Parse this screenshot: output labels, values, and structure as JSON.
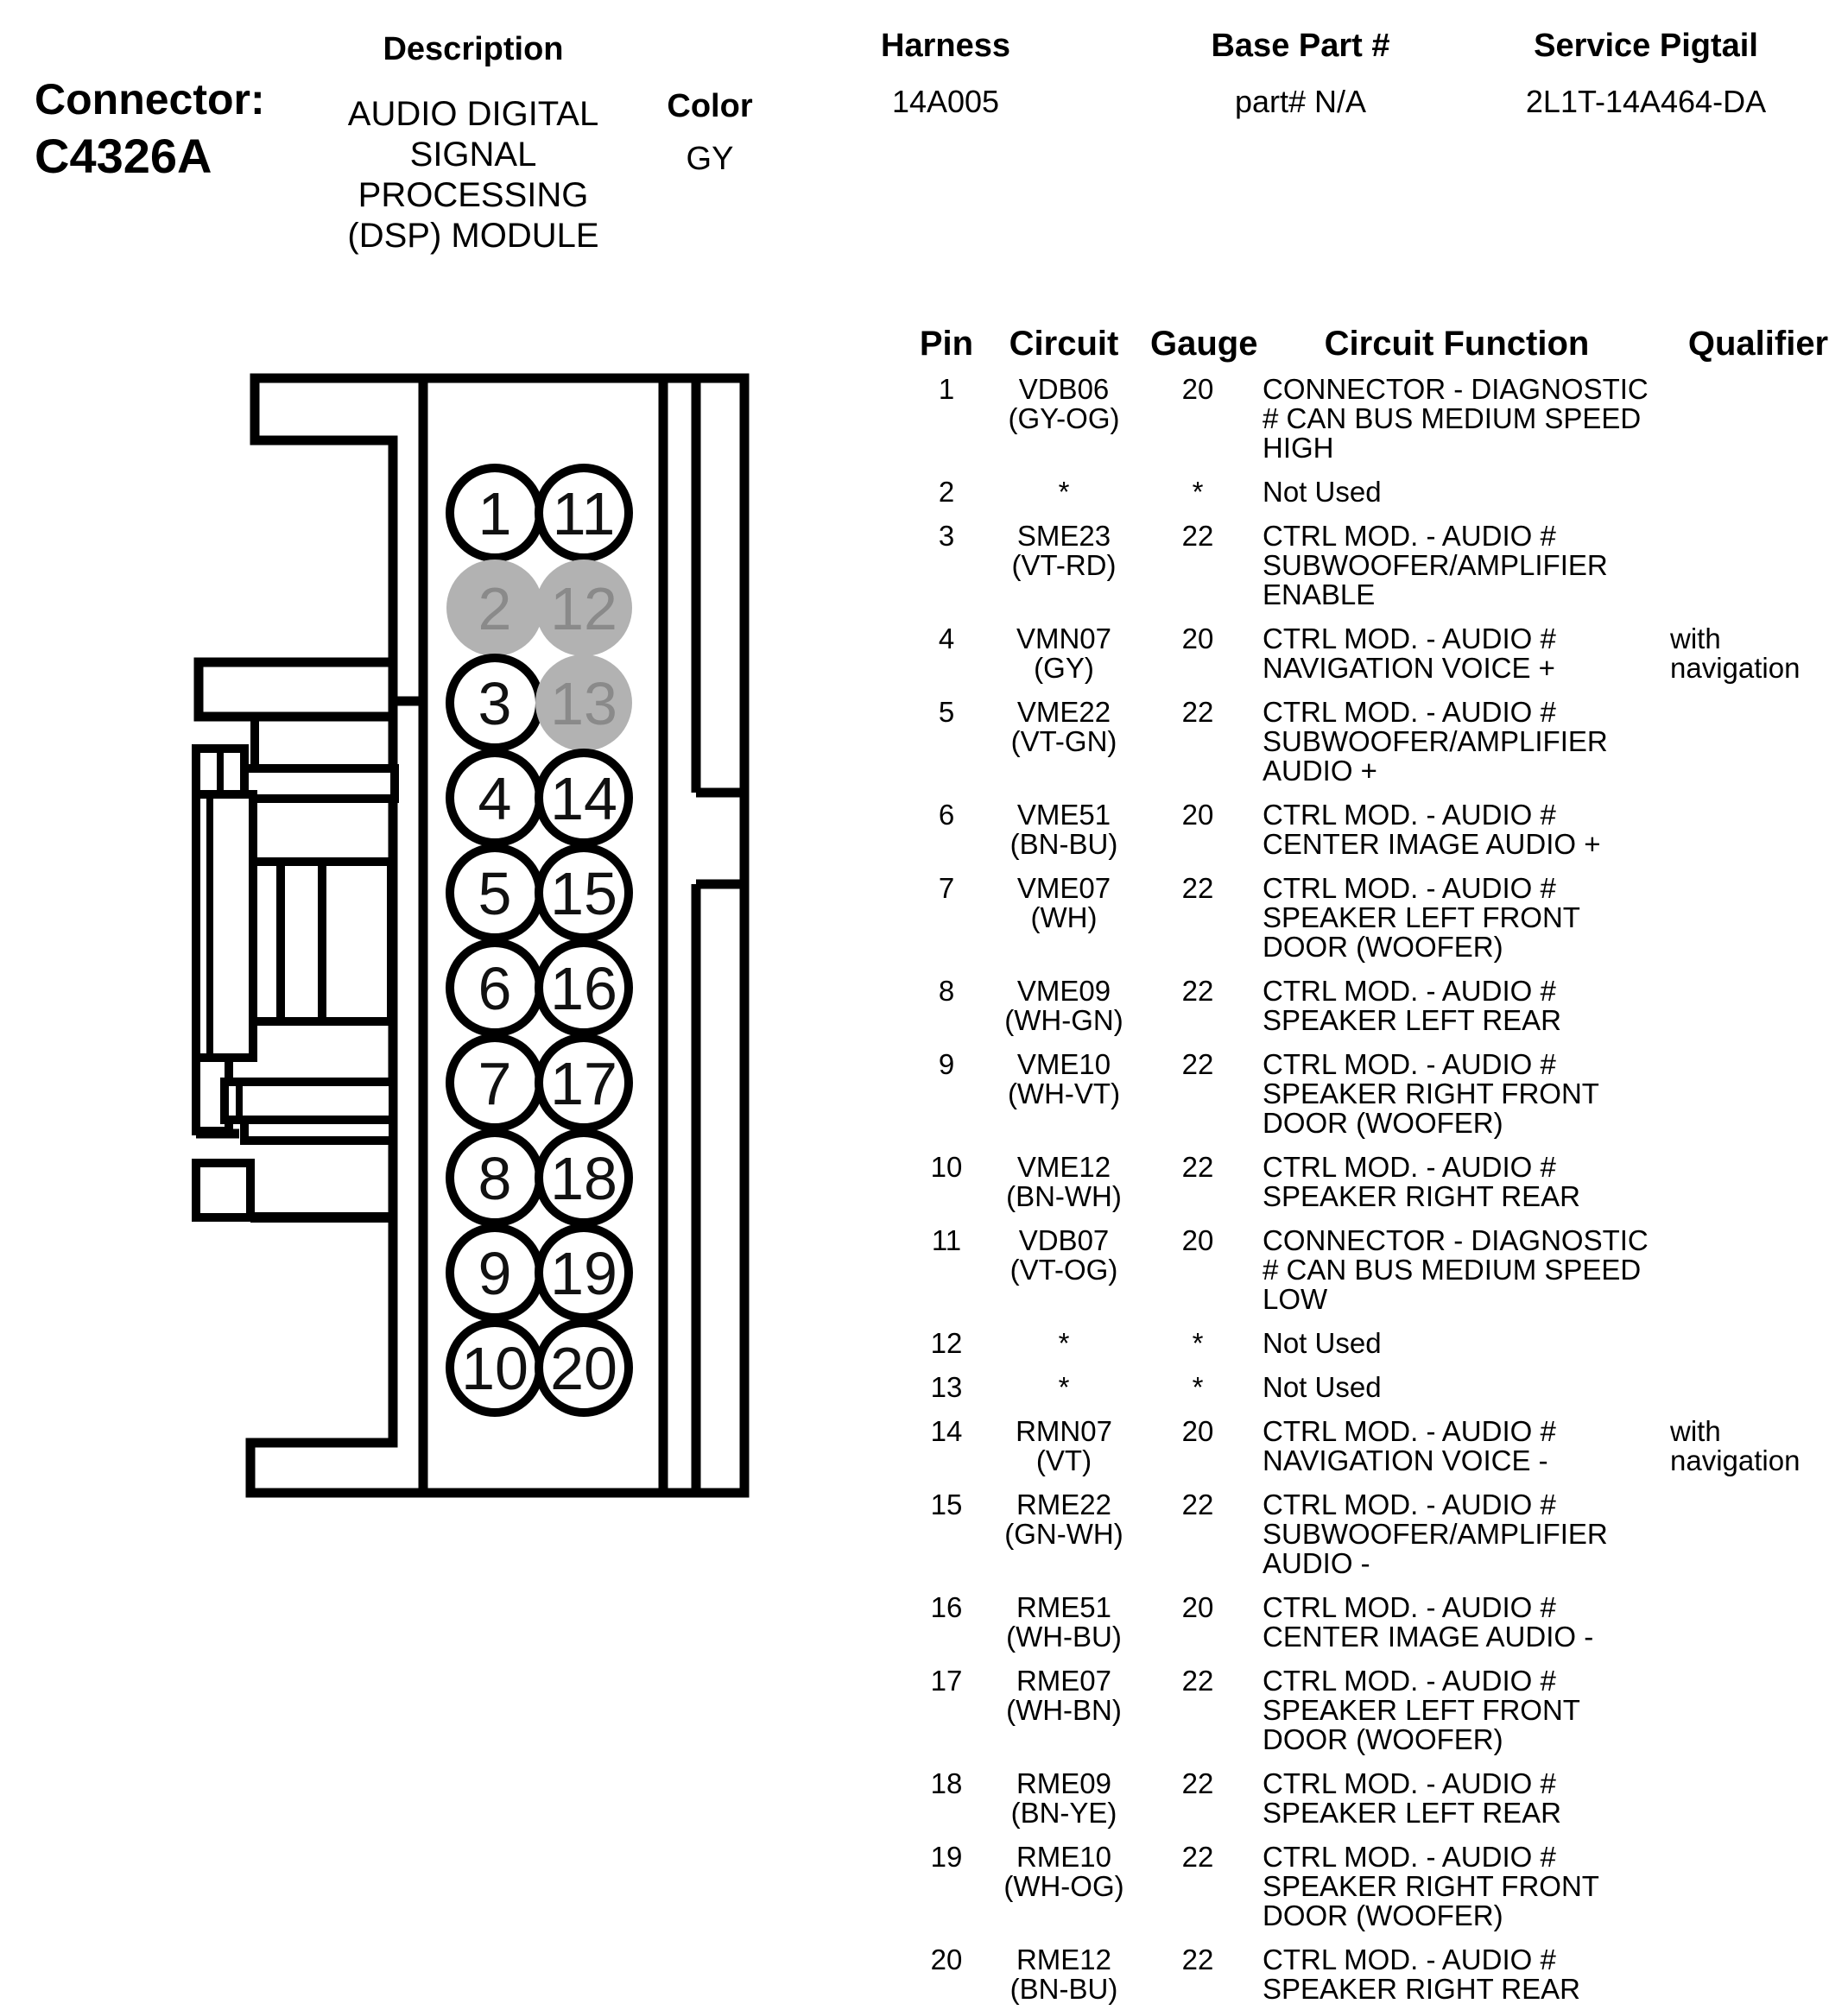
{
  "header": {
    "connector_label": "Connector:",
    "connector_id": "C4326A",
    "description_label": "Description",
    "description_lines": [
      "AUDIO DIGITAL",
      "SIGNAL",
      "PROCESSING",
      "(DSP) MODULE"
    ],
    "color_label": "Color",
    "color_value": "GY",
    "harness_label": "Harness",
    "harness_value": "14A005",
    "base_part_label": "Base Part #",
    "base_part_value": "part# N/A",
    "service_pigtail_label": "Service Pigtail",
    "service_pigtail_value": "2L1T-14A464-DA"
  },
  "diagram": {
    "left_column_pins": [
      1,
      2,
      3,
      4,
      5,
      6,
      7,
      8,
      9,
      10
    ],
    "right_column_pins": [
      11,
      12,
      13,
      14,
      15,
      16,
      17,
      18,
      19,
      20
    ],
    "unused_pins": [
      2,
      12,
      13
    ],
    "colors": {
      "outline": "#000000",
      "pin_fill": "#ffffff",
      "pin_text": "#111111",
      "unused_pin_fill": "#b2b2b2",
      "unused_pin_text": "#8a8a8a"
    }
  },
  "table": {
    "headers": {
      "pin": "Pin",
      "circuit": "Circuit",
      "gauge": "Gauge",
      "function": "Circuit Function",
      "qualifier": "Qualifier"
    },
    "rows": [
      {
        "pin": "1",
        "circuit_lines": [
          "VDB06",
          "(GY-OG)"
        ],
        "gauge": "20",
        "function_lines": [
          "CONNECTOR - DIAGNOSTIC",
          "# CAN BUS MEDIUM SPEED",
          "HIGH"
        ],
        "qualifier_lines": []
      },
      {
        "pin": "2",
        "circuit_lines": [
          "*"
        ],
        "gauge": "*",
        "function_lines": [
          "Not Used"
        ],
        "qualifier_lines": []
      },
      {
        "pin": "3",
        "circuit_lines": [
          "SME23",
          "(VT-RD)"
        ],
        "gauge": "22",
        "function_lines": [
          "CTRL MOD. - AUDIO #",
          "SUBWOOFER/AMPLIFIER",
          "ENABLE"
        ],
        "qualifier_lines": []
      },
      {
        "pin": "4",
        "circuit_lines": [
          "VMN07",
          "(GY)"
        ],
        "gauge": "20",
        "function_lines": [
          "CTRL MOD. - AUDIO #",
          "NAVIGATION VOICE +"
        ],
        "qualifier_lines": [
          "with",
          "navigation"
        ]
      },
      {
        "pin": "5",
        "circuit_lines": [
          "VME22",
          "(VT-GN)"
        ],
        "gauge": "22",
        "function_lines": [
          "CTRL MOD. - AUDIO #",
          "SUBWOOFER/AMPLIFIER",
          "AUDIO +"
        ],
        "qualifier_lines": []
      },
      {
        "pin": "6",
        "circuit_lines": [
          "VME51",
          "(BN-BU)"
        ],
        "gauge": "20",
        "function_lines": [
          "CTRL MOD. - AUDIO #",
          "CENTER IMAGE AUDIO +"
        ],
        "qualifier_lines": []
      },
      {
        "pin": "7",
        "circuit_lines": [
          "VME07",
          "(WH)"
        ],
        "gauge": "22",
        "function_lines": [
          "CTRL MOD. - AUDIO #",
          "SPEAKER LEFT FRONT",
          "DOOR (WOOFER)"
        ],
        "qualifier_lines": []
      },
      {
        "pin": "8",
        "circuit_lines": [
          "VME09",
          "(WH-GN)"
        ],
        "gauge": "22",
        "function_lines": [
          "CTRL MOD. - AUDIO #",
          "SPEAKER LEFT REAR"
        ],
        "qualifier_lines": []
      },
      {
        "pin": "9",
        "circuit_lines": [
          "VME10",
          "(WH-VT)"
        ],
        "gauge": "22",
        "function_lines": [
          "CTRL MOD. - AUDIO #",
          "SPEAKER RIGHT FRONT",
          "DOOR (WOOFER)"
        ],
        "qualifier_lines": []
      },
      {
        "pin": "10",
        "circuit_lines": [
          "VME12",
          "(BN-WH)"
        ],
        "gauge": "22",
        "function_lines": [
          "CTRL MOD. - AUDIO #",
          "SPEAKER RIGHT REAR"
        ],
        "qualifier_lines": []
      },
      {
        "pin": "11",
        "circuit_lines": [
          "VDB07",
          "(VT-OG)"
        ],
        "gauge": "20",
        "function_lines": [
          "CONNECTOR - DIAGNOSTIC",
          "# CAN BUS MEDIUM SPEED",
          "LOW"
        ],
        "qualifier_lines": []
      },
      {
        "pin": "12",
        "circuit_lines": [
          "*"
        ],
        "gauge": "*",
        "function_lines": [
          "Not Used"
        ],
        "qualifier_lines": []
      },
      {
        "pin": "13",
        "circuit_lines": [
          "*"
        ],
        "gauge": "*",
        "function_lines": [
          "Not Used"
        ],
        "qualifier_lines": []
      },
      {
        "pin": "14",
        "circuit_lines": [
          "RMN07",
          "(VT)"
        ],
        "gauge": "20",
        "function_lines": [
          "CTRL MOD. - AUDIO #",
          "NAVIGATION VOICE -"
        ],
        "qualifier_lines": [
          "with",
          "navigation"
        ]
      },
      {
        "pin": "15",
        "circuit_lines": [
          "RME22",
          "(GN-WH)"
        ],
        "gauge": "22",
        "function_lines": [
          "CTRL MOD. - AUDIO #",
          "SUBWOOFER/AMPLIFIER",
          "AUDIO -"
        ],
        "qualifier_lines": []
      },
      {
        "pin": "16",
        "circuit_lines": [
          "RME51",
          "(WH-BU)"
        ],
        "gauge": "20",
        "function_lines": [
          "CTRL MOD. - AUDIO #",
          "CENTER IMAGE AUDIO -"
        ],
        "qualifier_lines": []
      },
      {
        "pin": "17",
        "circuit_lines": [
          "RME07",
          "(WH-BN)"
        ],
        "gauge": "22",
        "function_lines": [
          "CTRL MOD. - AUDIO #",
          "SPEAKER LEFT FRONT",
          "DOOR (WOOFER)"
        ],
        "qualifier_lines": []
      },
      {
        "pin": "18",
        "circuit_lines": [
          "RME09",
          "(BN-YE)"
        ],
        "gauge": "22",
        "function_lines": [
          "CTRL MOD. - AUDIO #",
          "SPEAKER LEFT REAR"
        ],
        "qualifier_lines": []
      },
      {
        "pin": "19",
        "circuit_lines": [
          "RME10",
          "(WH-OG)"
        ],
        "gauge": "22",
        "function_lines": [
          "CTRL MOD. - AUDIO #",
          "SPEAKER RIGHT FRONT",
          "DOOR (WOOFER)"
        ],
        "qualifier_lines": []
      },
      {
        "pin": "20",
        "circuit_lines": [
          "RME12",
          "(BN-BU)"
        ],
        "gauge": "22",
        "function_lines": [
          "CTRL MOD. - AUDIO #",
          "SPEAKER RIGHT REAR"
        ],
        "qualifier_lines": []
      }
    ]
  }
}
